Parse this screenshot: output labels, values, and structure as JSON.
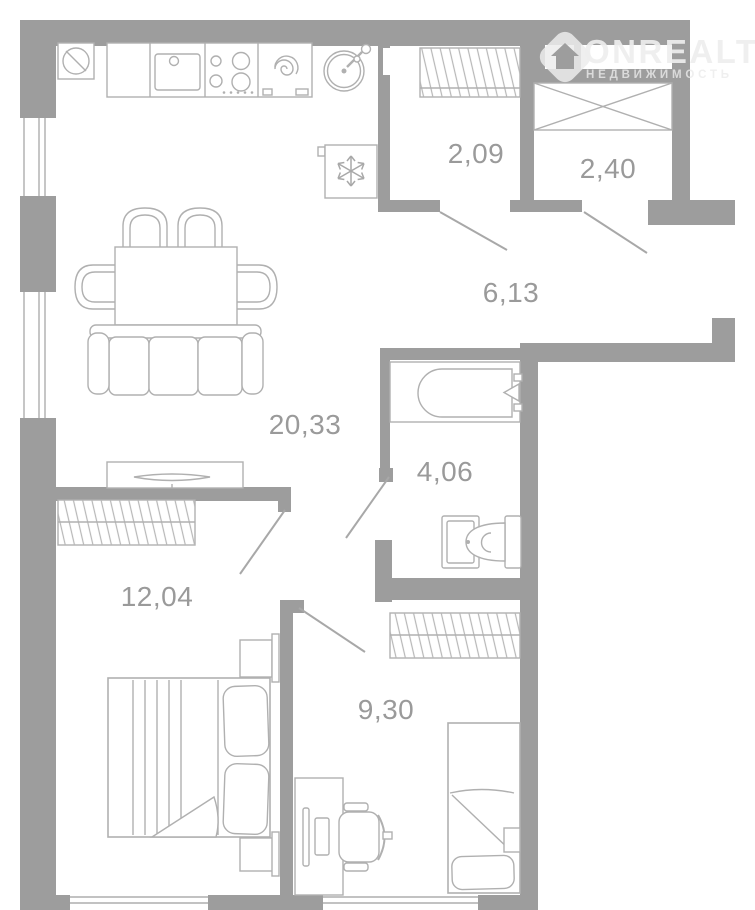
{
  "watermark": {
    "brand": "ONREALT",
    "subtitle": "НЕДВИЖИМОСТЬ"
  },
  "rooms": {
    "kitchen_living": {
      "area": "20,33"
    },
    "hallway": {
      "area": "6,13"
    },
    "closet": {
      "area": "2,09"
    },
    "entry": {
      "area": "2,40"
    },
    "bathroom": {
      "area": "4,06"
    },
    "bedroom": {
      "area": "12,04"
    },
    "child_room": {
      "area": "9,30"
    }
  },
  "colors": {
    "wall": "#9d9d9d",
    "furniture_line": "#b0b0b0",
    "label_text": "#9a9a9a",
    "watermark": "#ececec",
    "background": "#ffffff"
  }
}
